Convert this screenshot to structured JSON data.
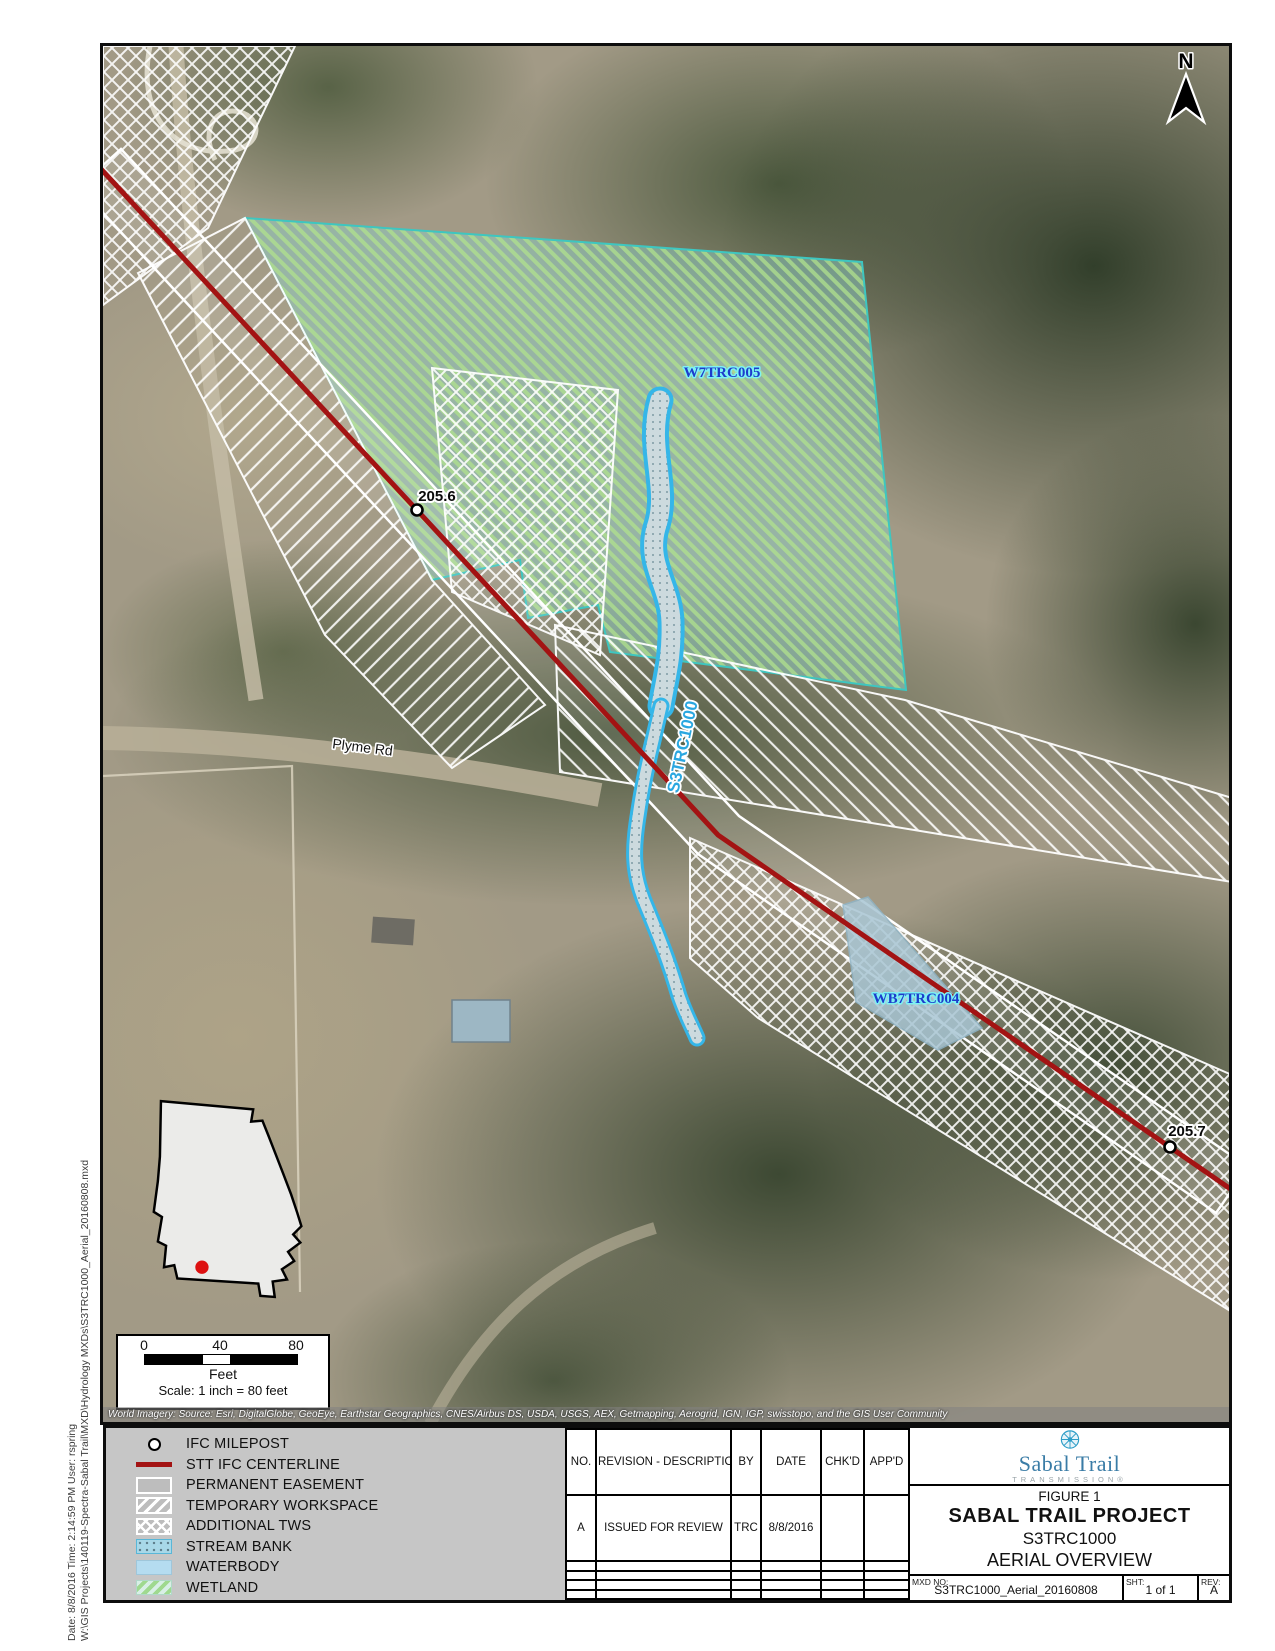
{
  "map": {
    "north_label": "N",
    "mileposts": [
      {
        "label": "205.6"
      },
      {
        "label": "205.7"
      }
    ],
    "labels": {
      "wetland": "W7TRC005",
      "stream": "S3TRC1000",
      "waterbody": "WB7TRC004",
      "road": "Plyme Rd"
    },
    "attribution": "World Imagery: Source: Esri, DigitalGlobe, GeoEye, Earthstar Geographics, CNES/Airbus DS, USDA, USGS, AEX, Getmapping, Aerogrid, IGN, IGP, swisstopo, and the GIS User Community",
    "scale_bar": {
      "ticks": [
        "0",
        "40",
        "80"
      ],
      "unit": "Feet",
      "scale_text": "Scale: 1 inch = 80 feet"
    },
    "colors": {
      "centerline": "#a31313",
      "stream_border": "#35b6e8",
      "wetland_hatch": "#9fd98f",
      "inset_dot": "#dd1111"
    }
  },
  "sidebar": {
    "line1": "Date: 8/8/2016 Time: 2:14:59 PM User: rspring",
    "line2": "W:\\GIS Projects\\140119-Spectra-Sabal Trail\\MXD\\Hydrology MXDs\\S3TRC1000_Aerial_20160808.mxd"
  },
  "legend": {
    "items": [
      {
        "label": "IFC MILEPOST",
        "symbol": "milepost-circle"
      },
      {
        "label": "STT IFC CENTERLINE",
        "symbol": "red-line"
      },
      {
        "label": "PERMANENT EASEMENT",
        "symbol": "gray-box-white-border"
      },
      {
        "label": "TEMPORARY WORKSPACE",
        "symbol": "diagonal-hatch"
      },
      {
        "label": "ADDITIONAL TWS",
        "symbol": "cross-hatch"
      },
      {
        "label": "STREAM BANK",
        "symbol": "dotted-blue"
      },
      {
        "label": "WATERBODY",
        "symbol": "light-blue"
      },
      {
        "label": "WETLAND",
        "symbol": "green-hatch"
      }
    ]
  },
  "revision_table": {
    "headers": [
      "NO.",
      "REVISION - DESCRIPTION",
      "BY",
      "DATE",
      "CHK'D",
      "APP'D"
    ],
    "rows": [
      [
        "A",
        "ISSUED FOR REVIEW",
        "TRC",
        "8/8/2016",
        "",
        ""
      ],
      [
        "",
        "",
        "",
        "",
        "",
        ""
      ],
      [
        "",
        "",
        "",
        "",
        "",
        ""
      ],
      [
        "",
        "",
        "",
        "",
        "",
        ""
      ],
      [
        "",
        "",
        "",
        "",
        "",
        ""
      ]
    ]
  },
  "title_block": {
    "logo_name": "Sabal Trail",
    "logo_sub": "TRANSMISSION®",
    "figure": "FIGURE 1",
    "project": "SABAL TRAIL PROJECT",
    "code": "S3TRC1000",
    "subtitle": "AERIAL OVERVIEW",
    "mxd_label": "MXD NO:",
    "mxd_no": "S3TRC1000_Aerial_20160808",
    "sht_label": "SHT:",
    "sheet": "1 of 1",
    "rev_label": "REV:",
    "rev": "A"
  }
}
